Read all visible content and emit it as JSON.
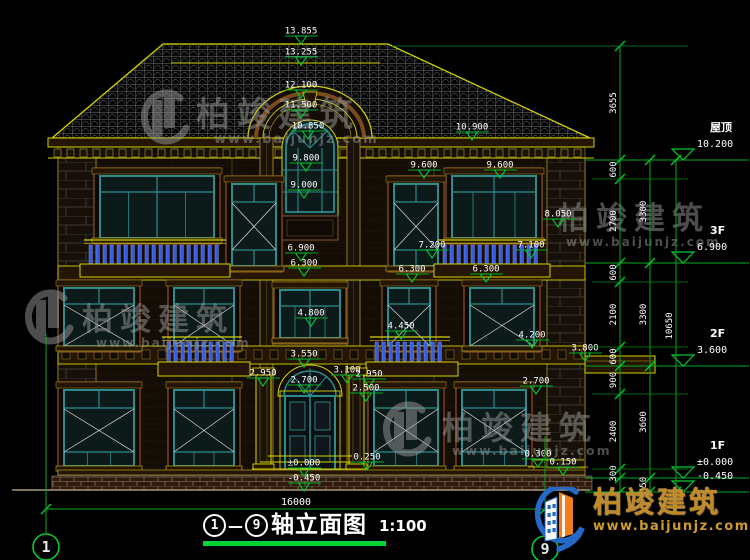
{
  "title": {
    "axis_start": "1",
    "axis_end": "9",
    "separator": "—",
    "text": "轴立面图",
    "scale": "1:100"
  },
  "brand": {
    "name": "柏竣建筑",
    "url": "www.baijunjz.com"
  },
  "watermark": {
    "name": "柏竣建筑",
    "url": "www.baijunjz.com"
  },
  "ground_dimension": {
    "value": "16000",
    "x1": 46,
    "x2": 545,
    "y": 509,
    "text_x": 296,
    "text_y": 505
  },
  "axis_bubbles": [
    {
      "label": "1",
      "x": 46,
      "cy": 547,
      "line_top": 334,
      "line_bottom": 533
    },
    {
      "label": "9",
      "x": 545,
      "cy": 549,
      "line_top": 436,
      "line_bottom": 535
    }
  ],
  "floor_levels": [
    {
      "label": "屋顶",
      "value": "10.200",
      "y": 160
    },
    {
      "label": "3F",
      "value": "6.900",
      "y": 263
    },
    {
      "label": "2F",
      "value": "3.600",
      "y": 366
    },
    {
      "label": "1F",
      "value": "±0.000",
      "y": 478
    },
    {
      "label": "",
      "value": "-0.450",
      "y": 492
    }
  ],
  "spot_elevations": [
    {
      "value": "13.855",
      "x": 301,
      "y": 36
    },
    {
      "value": "13.255",
      "x": 301,
      "y": 57
    },
    {
      "value": "12.100",
      "x": 301,
      "y": 90
    },
    {
      "value": "11.500",
      "x": 301,
      "y": 110
    },
    {
      "value": "10.850",
      "x": 308,
      "y": 131
    },
    {
      "value": "10.900",
      "x": 472,
      "y": 132
    },
    {
      "value": "9.800",
      "x": 306,
      "y": 163
    },
    {
      "value": "9.600",
      "x": 424,
      "y": 170
    },
    {
      "value": "9.600",
      "x": 500,
      "y": 170
    },
    {
      "value": "9.000",
      "x": 304,
      "y": 190
    },
    {
      "value": "8.050",
      "x": 558,
      "y": 219
    },
    {
      "value": "7.200",
      "x": 432,
      "y": 250
    },
    {
      "value": "7.100",
      "x": 531,
      "y": 250
    },
    {
      "value": "6.900",
      "x": 301,
      "y": 253
    },
    {
      "value": "6.300",
      "x": 304,
      "y": 268
    },
    {
      "value": "6.300",
      "x": 412,
      "y": 274
    },
    {
      "value": "6.300",
      "x": 486,
      "y": 274
    },
    {
      "value": "4.800",
      "x": 311,
      "y": 318
    },
    {
      "value": "4.450",
      "x": 401,
      "y": 331
    },
    {
      "value": "4.200",
      "x": 532,
      "y": 340
    },
    {
      "value": "3.800",
      "x": 585,
      "y": 353
    },
    {
      "value": "3.550",
      "x": 304,
      "y": 359
    },
    {
      "value": "3.100",
      "x": 347,
      "y": 375
    },
    {
      "value": "2.950",
      "x": 263,
      "y": 378
    },
    {
      "value": "2.950",
      "x": 369,
      "y": 379
    },
    {
      "value": "2.700",
      "x": 304,
      "y": 385
    },
    {
      "value": "2.700",
      "x": 536,
      "y": 386
    },
    {
      "value": "2.500",
      "x": 366,
      "y": 393
    },
    {
      "value": "0.250",
      "x": 367,
      "y": 462
    },
    {
      "value": "0.300",
      "x": 538,
      "y": 459
    },
    {
      "value": "0.150",
      "x": 563,
      "y": 467
    },
    {
      "value": "±0.000",
      "x": 304,
      "y": 468
    },
    {
      "value": "-0.450",
      "x": 304,
      "y": 483
    }
  ],
  "dim_chains": [
    {
      "x": 620,
      "nodes": [
        46,
        160,
        179,
        263,
        282,
        347,
        366,
        394,
        469,
        478,
        492
      ],
      "labels": [
        "3655",
        "600",
        "2700",
        "600",
        "2100",
        "600",
        "900",
        "2400",
        "300",
        ""
      ]
    },
    {
      "x": 650,
      "nodes": [
        160,
        263,
        366,
        478,
        492
      ],
      "labels": [
        "3300",
        "3300",
        "3600",
        "450"
      ]
    },
    {
      "x": 676,
      "nodes": [
        160,
        492
      ],
      "labels": [
        "10650"
      ]
    }
  ],
  "extension_lines": {
    "minor_ys": [
      179,
      282,
      347,
      394,
      469
    ],
    "ridge_y": 46
  },
  "watermarks": [
    {
      "icon_x": 136,
      "icon_y": 90,
      "text_x": 196,
      "text_y": 126,
      "size": 34,
      "url_x": 214,
      "url_y": 143,
      "url_size": 13
    },
    {
      "icon_x": 20,
      "icon_y": 290,
      "text_x": 82,
      "text_y": 330,
      "size": 31,
      "url_x": 96,
      "url_y": 347,
      "url_size": 12
    },
    {
      "text_x": 558,
      "text_y": 229,
      "size": 31,
      "url_x": 566,
      "url_y": 246,
      "url_size": 12
    },
    {
      "icon_x": 378,
      "icon_y": 402,
      "text_x": 442,
      "text_y": 439,
      "size": 32,
      "url_x": 452,
      "url_y": 455,
      "url_size": 12.5
    }
  ],
  "colors": {
    "line_yellow": "#d4d400",
    "dim_green": "#00cc33",
    "frame_teal": "#2e8b8b",
    "baluster_blue": "#3a5ae0",
    "brand_gold": "#c08a28",
    "watermark_gray": "#9a9a9a"
  }
}
